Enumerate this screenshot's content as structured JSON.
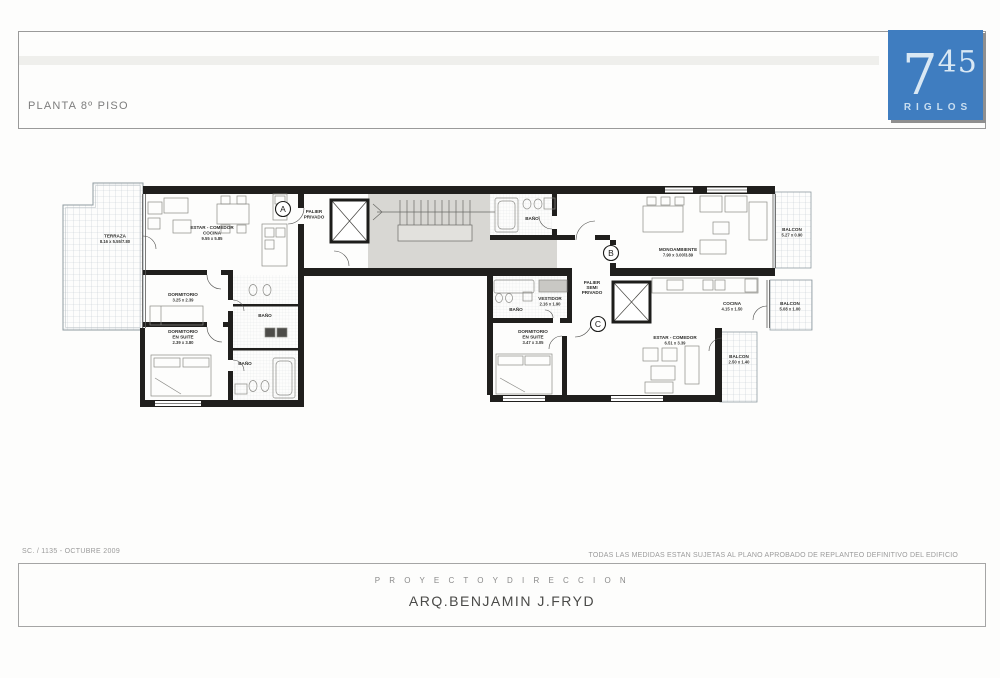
{
  "header": {
    "title": "PLANTA 8º PISO"
  },
  "logo": {
    "big_digit": "7",
    "sup_digits": "45",
    "brand": "RIGLOS",
    "bg_color": "#3f7dc0"
  },
  "colors": {
    "wall": "#201f1d",
    "core_fill": "#d8d7d3",
    "logo_blue": "#3f7dc0",
    "hatch": "#c5cdd2"
  },
  "plan": {
    "markers": {
      "a": "A",
      "b": "B",
      "c": "C"
    },
    "rooms": {
      "terraza": {
        "name": "TERRAZA",
        "dims": "8.16 x 5.55/7.80"
      },
      "estar_a": {
        "name": "ESTAR - COMEDOR",
        "name2": "COCINA",
        "dims": "9.55 x 5.85"
      },
      "dorm_a": {
        "name": "DORMITORIO",
        "dims": "3.25 x 2.39"
      },
      "suite_a": {
        "name": "DORMITORIO",
        "name2": "EN SUITE",
        "dims": "2.39 x 3.80"
      },
      "bano_a1": {
        "name": "BAÑO"
      },
      "bano_a2": {
        "name": "BAÑO"
      },
      "palier_a": {
        "name": "PALIER",
        "name2": "PRIVADO"
      },
      "bano_b": {
        "name": "BAÑO"
      },
      "mono_b": {
        "name": "MONOAMBIENTE",
        "dims": "7.90 x 3.00/3.89"
      },
      "balcon_b": {
        "name": "BALCON",
        "dims": "5.27 x 0.90"
      },
      "palier_bc": {
        "name": "PALIER",
        "name2": "SEMI",
        "name3": "PRIVADO"
      },
      "bano_c": {
        "name": "BAÑO"
      },
      "vestidor_c": {
        "name": "VESTIDOR",
        "dims": "2.16 x 1.90"
      },
      "suite_c": {
        "name": "DORMITORIO",
        "name2": "EN SUITE",
        "dims": "3.47 x 3.05"
      },
      "estar_c": {
        "name": "ESTAR - COMEDOR",
        "dims": "6.51 x 3.39"
      },
      "cocina_c": {
        "name": "COCINA",
        "dims": "4.15 x 1.50"
      },
      "balcon_c1": {
        "name": "BALCON",
        "dims": "5.08 x 1.00"
      },
      "balcon_c2": {
        "name": "BALCON",
        "dims": "2.50 x 1.40"
      }
    }
  },
  "footer": {
    "doc_ref": "SC. / 1135 - OCTUBRE 2009",
    "disclaimer": "TODAS LAS MEDIDAS ESTAN SUJETAS AL PLANO APROBADO DE REPLANTEO DEFINITIVO DEL EDIFICIO",
    "project_label": "P R O Y E C T O   Y   D I R E C C I O N",
    "architect": "ARQ.BENJAMIN J.FRYD"
  }
}
